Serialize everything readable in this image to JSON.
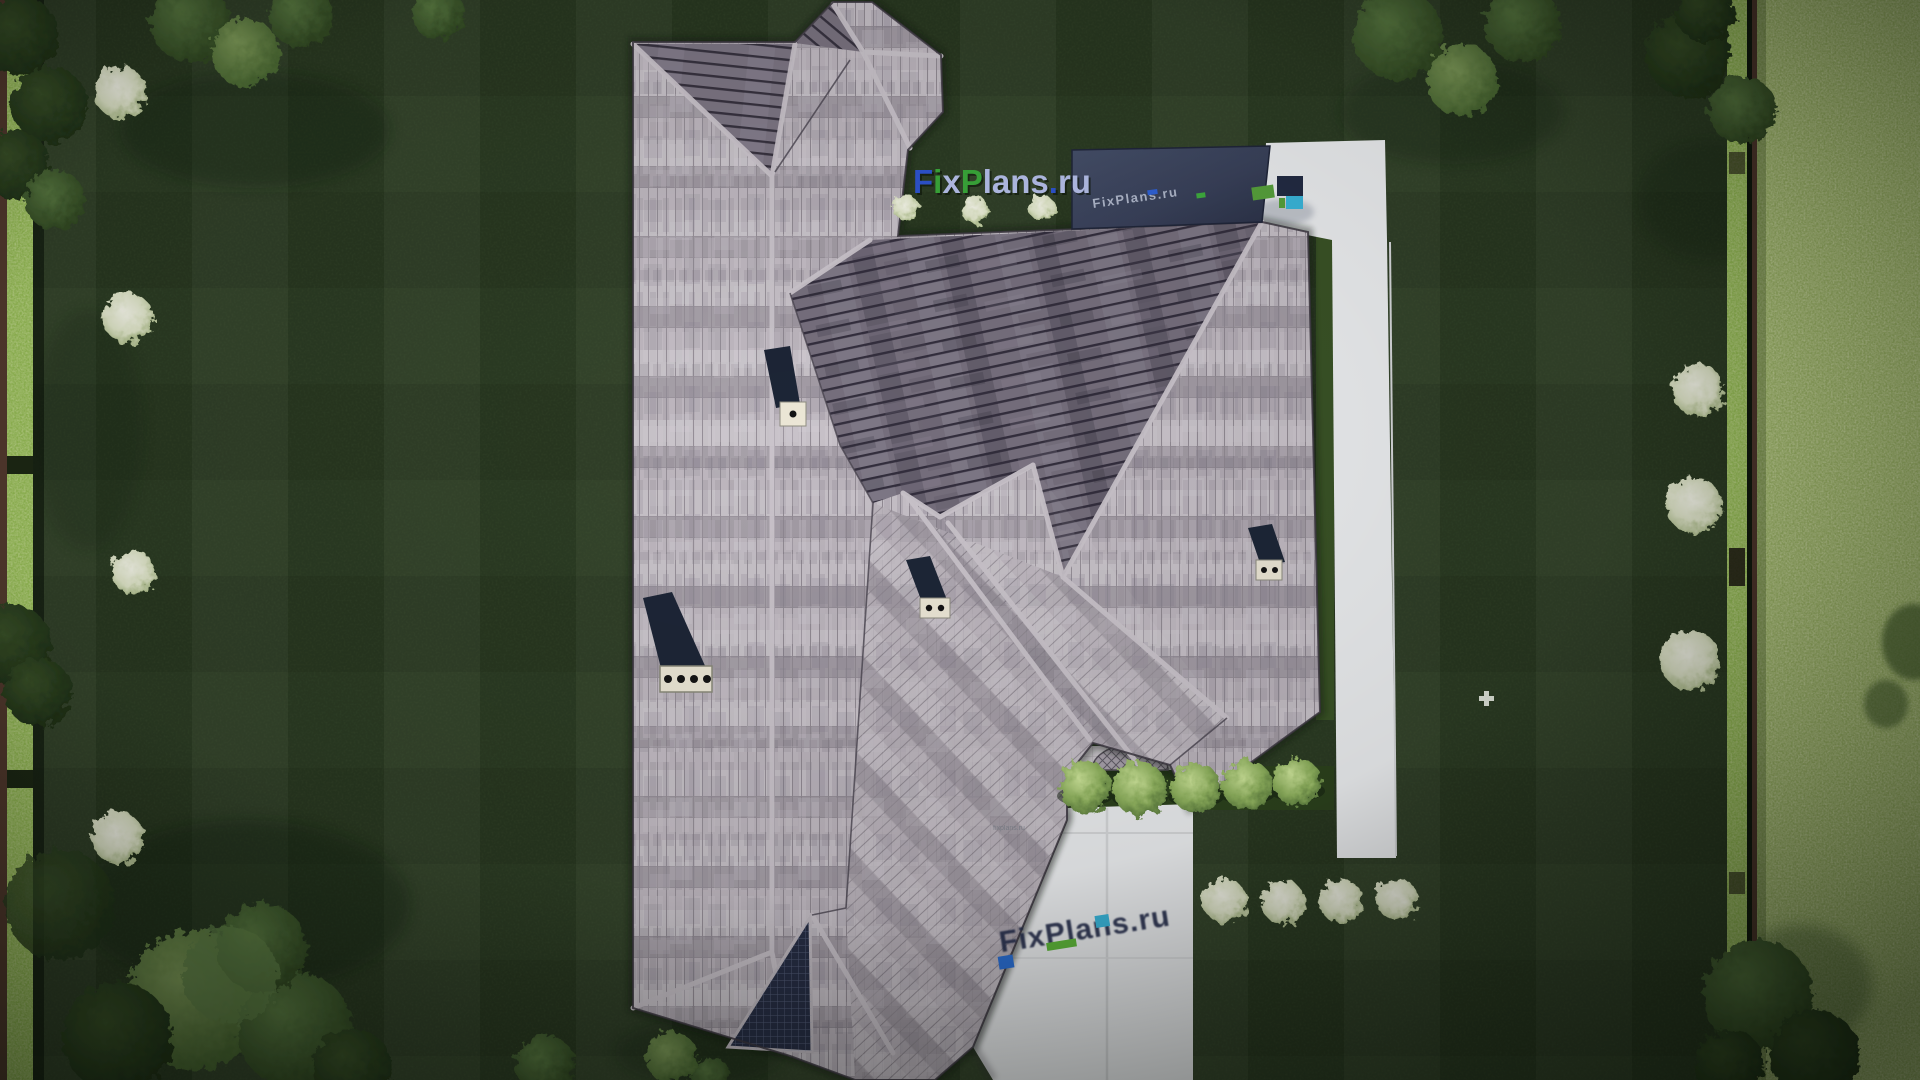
{
  "scene": {
    "title": "Aerial top-down render of house roof plan",
    "watermarks": {
      "top": {
        "text": "FixPlans.ru",
        "letters": [
          {
            "ch": "F",
            "color": "#2e54cf"
          },
          {
            "ch": "i",
            "color": "#3aa83a"
          },
          {
            "ch": "x",
            "color": "#b6c0ea"
          },
          {
            "ch": "P",
            "color": "#3aa83a"
          },
          {
            "ch": "l",
            "color": "#b6c0ea"
          },
          {
            "ch": "a",
            "color": "#b6c0ea"
          },
          {
            "ch": "n",
            "color": "#b6c0ea"
          },
          {
            "ch": "s",
            "color": "#b6c0ea"
          },
          {
            "ch": ".",
            "color": "#2e54cf"
          },
          {
            "ch": "r",
            "color": "#b6c0ea"
          },
          {
            "ch": "u",
            "color": "#b6c0ea"
          }
        ]
      },
      "driveway": {
        "text": "FixPlans.ru",
        "color": "#262f4e",
        "accent_blue": "#2b6fd4",
        "accent_green": "#5fb83a",
        "accent_cyan": "#3ab7dc"
      },
      "canopy": {
        "text": "FixPlans.ru",
        "color": "#c5cddf"
      },
      "edge_tiny": {
        "text": "fixplans.ru"
      }
    },
    "palette": {
      "lawn_dark": "#2b3b23",
      "lawn_strip": "#3a5326",
      "field_bright": "#a3bc6b",
      "hedge": "#96bd55",
      "fence": "#533a2e",
      "pavement": "#edeff1",
      "roof_light": "#b0a9b1",
      "roof_dark": "#766f7d",
      "canopy_navy": "#3a4258",
      "chimney_body": "#1d2637",
      "chimney_cap": "#ece7d6",
      "bush_green": "#8fb25e",
      "flower_white": "#f0f2e2"
    },
    "objects": {
      "chimneys": "4",
      "round_bushes": "5",
      "flower_bushes": "4",
      "patio_dome": "lattice half-dome",
      "canopy": "dark flat glass canopy"
    }
  }
}
